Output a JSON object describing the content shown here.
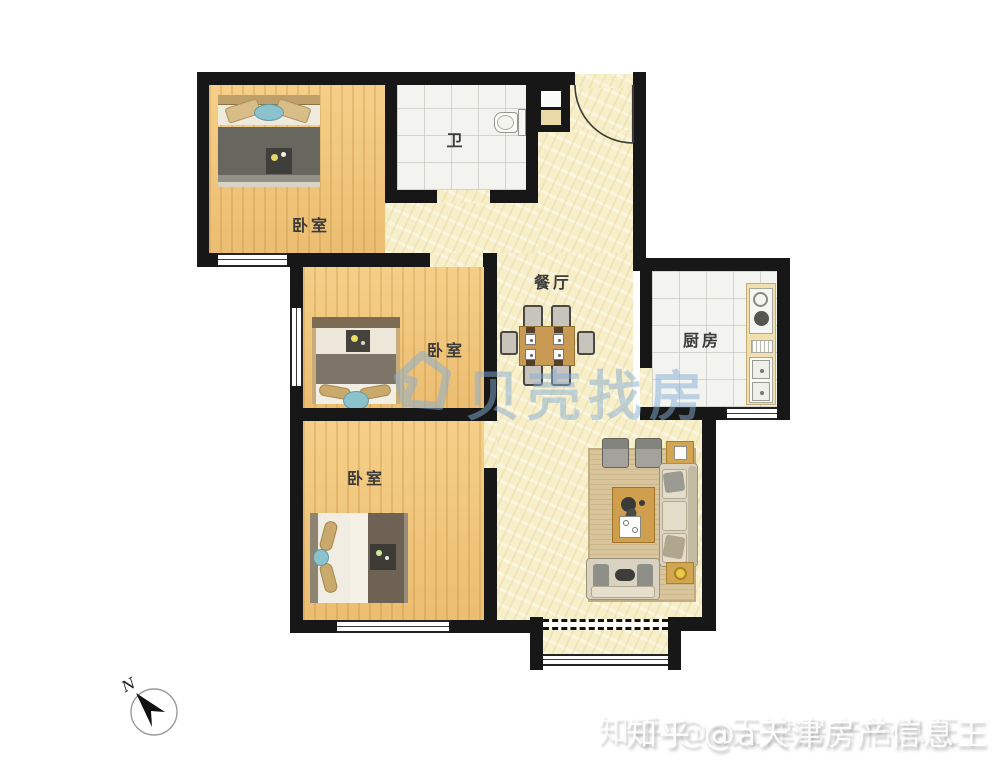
{
  "plan": {
    "rooms": [
      {
        "id": "bedroom-top",
        "label": "卧室"
      },
      {
        "id": "bathroom",
        "label": "卫"
      },
      {
        "id": "dining",
        "label": "餐厅"
      },
      {
        "id": "kitchen",
        "label": "厨房"
      },
      {
        "id": "bedroom-middle",
        "label": "卧室"
      },
      {
        "id": "bedroom-bottom",
        "label": "卧室"
      }
    ],
    "compass": {
      "label": "N"
    },
    "watermarks": {
      "beike": "贝壳找房",
      "zhihu": "知乎 @a天津房产信息王"
    },
    "colors": {
      "wall": "#171717",
      "wood_floor": "#f1c67a",
      "cream_floor": "#f7efc9",
      "tile_floor": "#f3f3f0",
      "watermark_blue": "#86aed6",
      "accent_teal": "#8cc2cb",
      "furniture_wood": "#cf9f4e"
    }
  }
}
